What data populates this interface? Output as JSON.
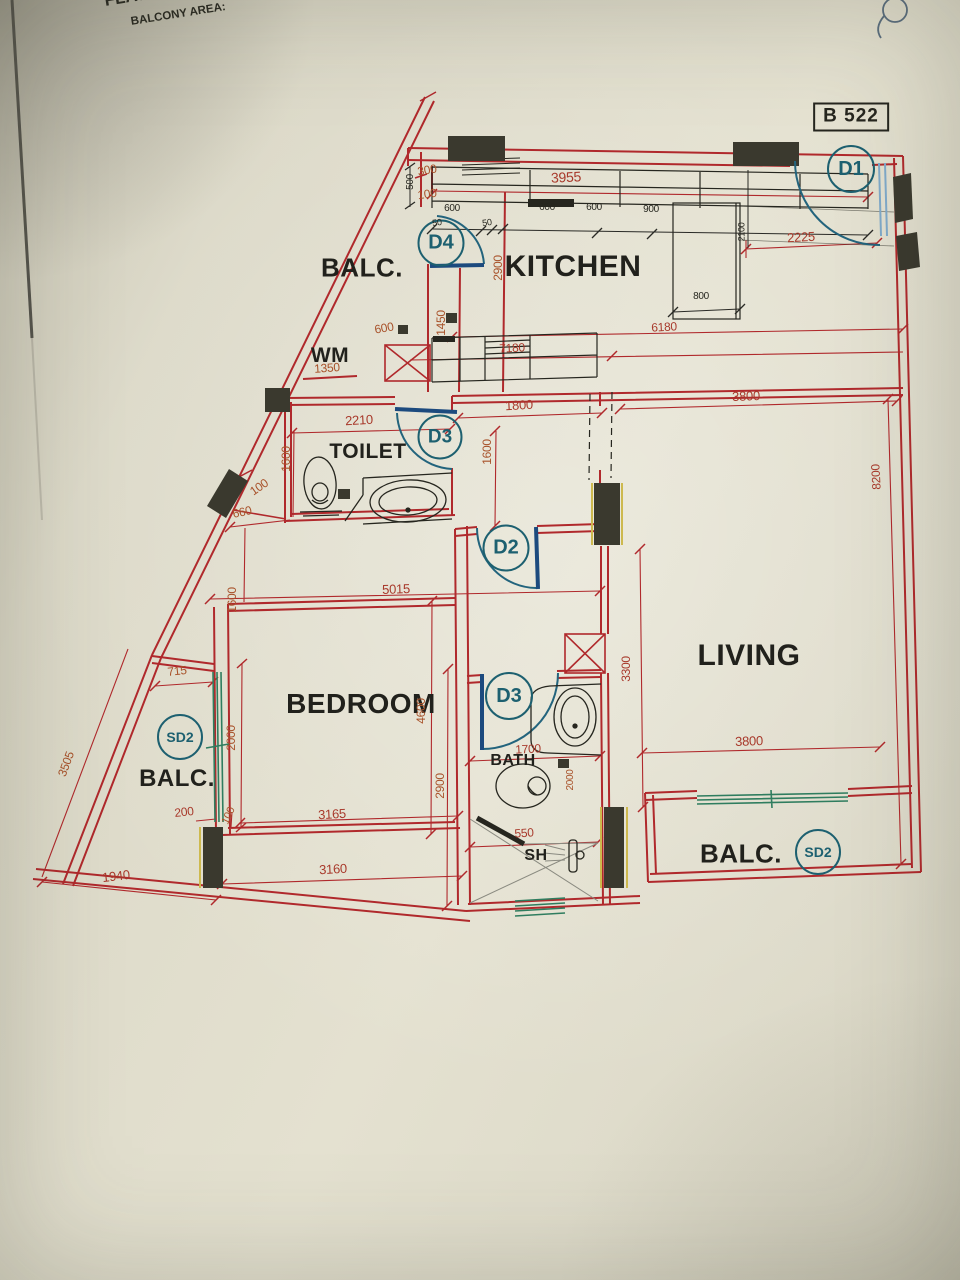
{
  "sheet": {
    "code": "B 522"
  },
  "header": {
    "line1": "FLAT",
    "line2": "BALCONY AREA:"
  },
  "rooms": {
    "kitchen": "KITCHEN",
    "toilet": "TOILET",
    "bedroom": "BEDROOM",
    "living": "LIVING",
    "bath": "BATH",
    "shower": "SH",
    "washer": "WM",
    "balc_top": "BALC.",
    "balc_left": "BALC.",
    "balc_bottom": "BALC."
  },
  "door_tags": {
    "d1": "D1",
    "d2": "D2",
    "d3_toilet": "D3",
    "d3_bath": "D3",
    "d4": "D4",
    "sd2_left": "SD2",
    "sd2_bottom": "SD2"
  },
  "dims": [
    "300",
    "100",
    "3955",
    "2900",
    "1450",
    "600",
    "1350",
    "7180",
    "6180",
    "2225",
    "2210",
    "1600",
    "100",
    "660",
    "1800",
    "1600",
    "3800",
    "8200",
    "5015",
    "1600",
    "2000",
    "4600",
    "2900",
    "3300",
    "715",
    "3505",
    "200",
    "100",
    "3165",
    "1940",
    "3160",
    "550",
    "1700",
    "3800",
    "2000",
    "500",
    "600",
    "50",
    "50",
    "600",
    "600",
    "900",
    "2100",
    "800"
  ],
  "colors": {
    "wall_red": "#b0292c",
    "dim_red": "#a8392b",
    "dim_orange": "#a8522a",
    "ink_black": "#26261f",
    "tag_teal": "#1d6070",
    "door_blue": "#1c4a7e",
    "window_green": "#2f7d5f",
    "column_fill": "#3a392e",
    "column_yellow": "#cdb94e",
    "paper": "#e0ddcd"
  }
}
